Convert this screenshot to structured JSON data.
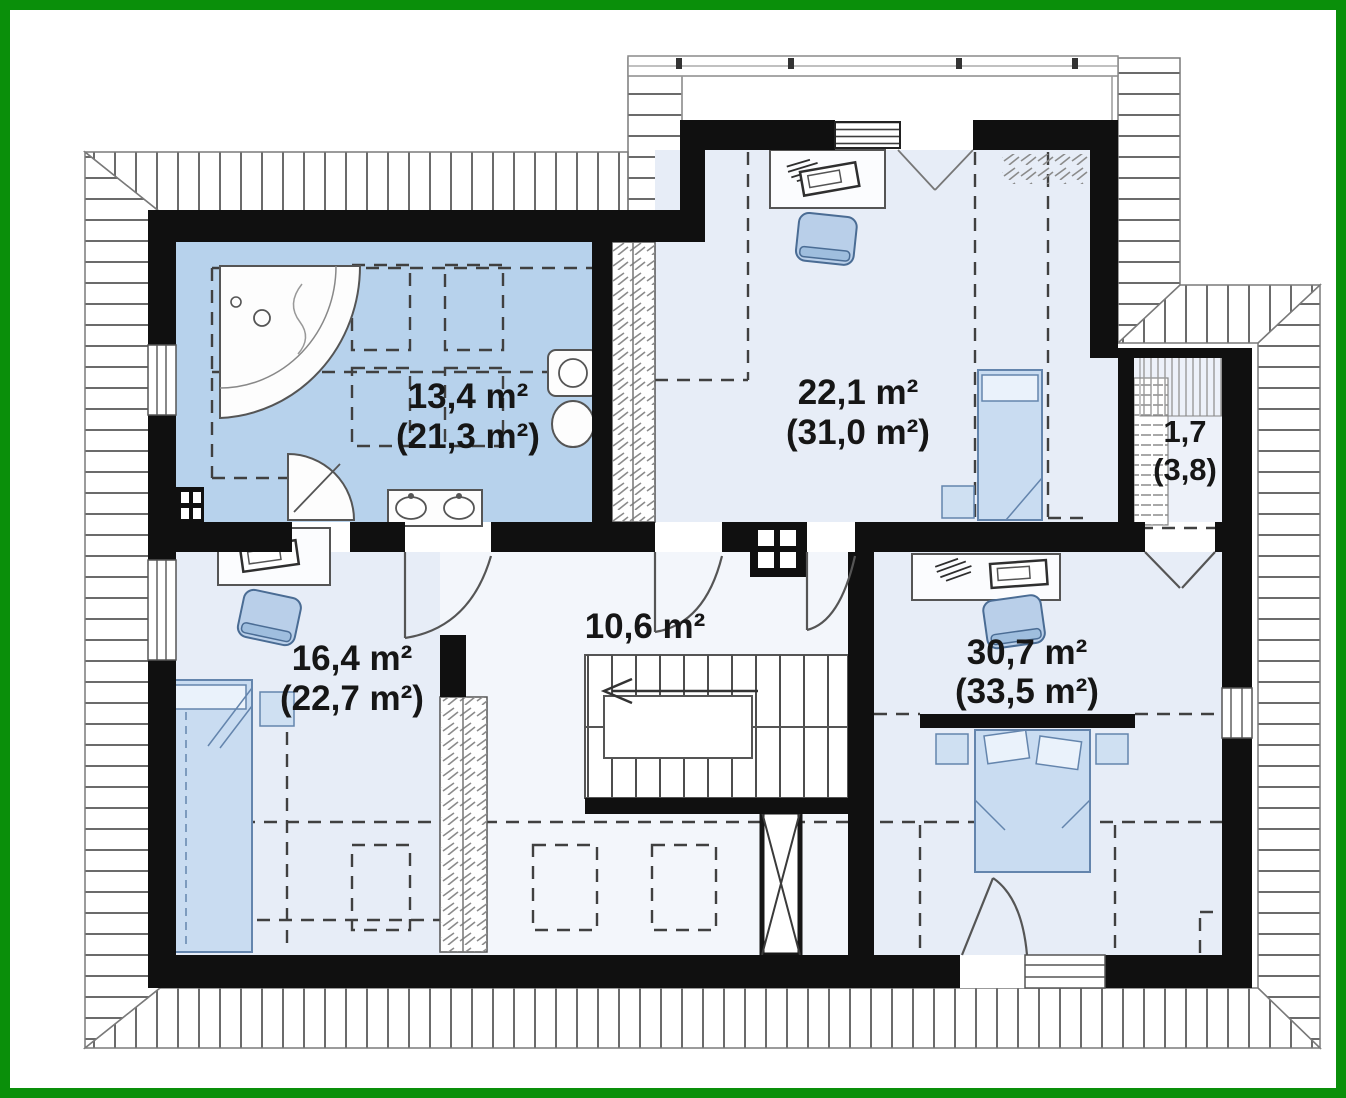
{
  "frame": {
    "border_color": "#0a8f0a",
    "background": "#ffffff"
  },
  "plan": {
    "type": "floor-plan",
    "floor": "attic-storey",
    "colors": {
      "wall": "#101010",
      "roof_hatch": "#6b6b6b",
      "bathroom_fill": "#b7d2ec",
      "room_fill": "#e7edf7",
      "hall_fill": "#f3f6fb",
      "closet_fill": "#edf1f9",
      "furniture_blue": "#b9cfe9",
      "bed_blue": "#c9dcf1",
      "dashed_line": "#404040"
    },
    "rooms": [
      {
        "id": "bathroom",
        "label": "13,4 m²",
        "label_total": "(21,3 m²)",
        "furniture": [
          "corner-bathtub",
          "shower-cabin",
          "double-washbasin",
          "toilet",
          "wardrobe"
        ]
      },
      {
        "id": "bedroom-top",
        "label": "22,1 m²",
        "label_total": "(31,0 m²)",
        "furniture": [
          "desk",
          "monitor",
          "office-chair",
          "single-bed",
          "nightstand",
          "wardrobe",
          "dormer-window"
        ]
      },
      {
        "id": "storage-closet",
        "label": "1,7",
        "label_total": "(3,8)",
        "furniture": [
          "shelving",
          "roof-window"
        ]
      },
      {
        "id": "bedroom-left",
        "label": "16,4 m²",
        "label_total": "(22,7 m²)",
        "furniture": [
          "desk",
          "monitor",
          "office-chair",
          "single-bed",
          "nightstand",
          "wardrobe"
        ]
      },
      {
        "id": "hall",
        "label": "10,6 m²",
        "label_total": "",
        "furniture": [
          "staircase",
          "chimney-shaft"
        ]
      },
      {
        "id": "bedroom-right",
        "label": "30,7 m²",
        "label_total": "(33,5 m²)",
        "furniture": [
          "desk",
          "monitor",
          "office-chair",
          "double-bed",
          "nightstand",
          "nightstand"
        ]
      }
    ],
    "stairs_direction": "left"
  }
}
